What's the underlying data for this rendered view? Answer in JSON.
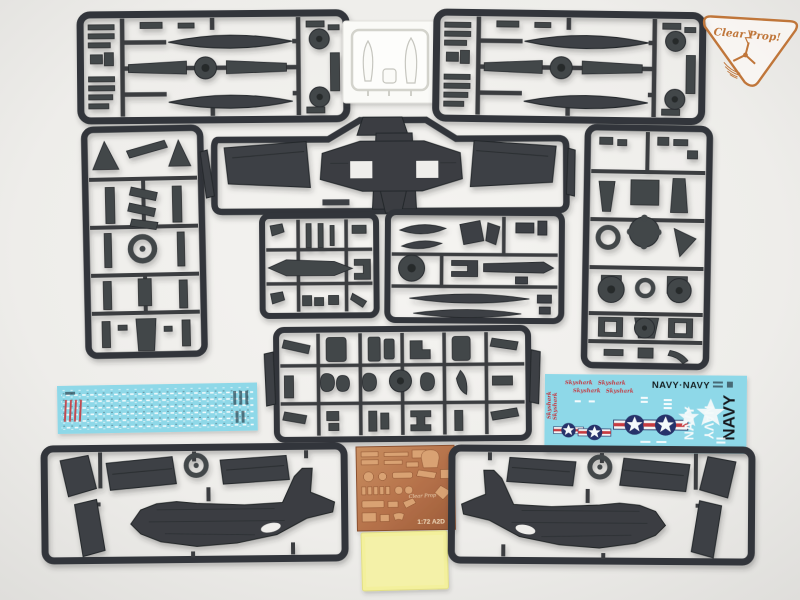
{
  "scene": {
    "description": "Flat-lay photo of a 1/72 Douglas A2D Skyshark plastic model kit contents: grey injection sprues, clear canopy sprue, stencil and marking decal sheets, photo-etched brass fret, yellow mask sheet",
    "background_color": "#efeeeb",
    "plastic_color": "#3e4145"
  },
  "logo": {
    "brand": "Clear Prop!"
  },
  "photo_etch": {
    "brand": "Clear Prop",
    "scale_label": "1:72 A2D"
  },
  "decal_main": {
    "script_name": "Skyshark",
    "navy_pair": "NAVY·NAVY",
    "navy_vertical_white_1": "NAVY",
    "navy_vertical_white_2": "NAVY",
    "navy_vertical_black": "NAVY"
  },
  "colors": {
    "sprue_frame": "#33363a",
    "part_fill": "#3e4145",
    "decal_cyan": "#8ed8e8",
    "etch_copper": "#b5714a",
    "mask_yellow": "#f3f09c",
    "logo_orange": "#c0763a",
    "insignia_blue": "#27336b",
    "insignia_red": "#c83a40"
  }
}
